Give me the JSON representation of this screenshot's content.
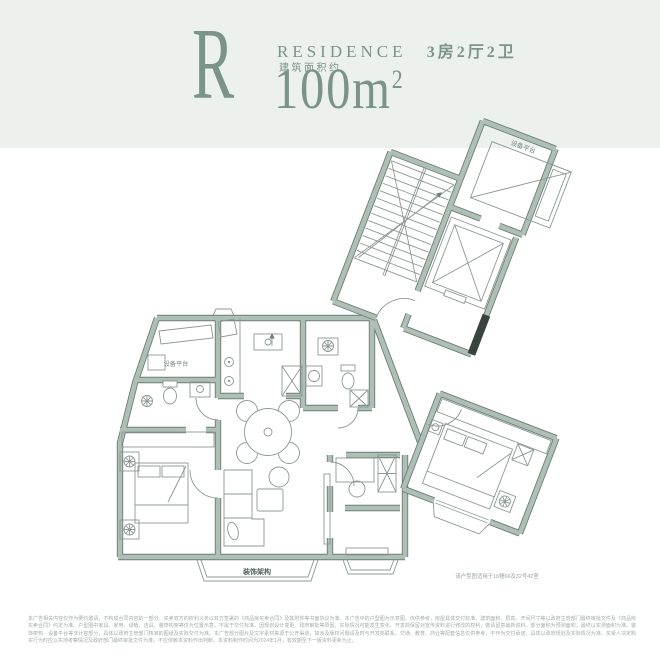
{
  "header": {
    "type_letter": "R",
    "residence_word": "RESIDENCE",
    "rooms_label": "3房2厅2卫",
    "area_prefix": "建筑面积约",
    "area_number": "100",
    "area_unit": "m",
    "area_exponent": "2"
  },
  "plan": {
    "labels": {
      "platform_top": "设备平台",
      "platform_left": "设备平台",
      "decor_structure": "装饰架构",
      "caption": "该户型图适用于16幢66及32号42室"
    }
  },
  "footer": {
    "disclaimer": "本广告相关内容仅作为要约邀请，不构成合同内容的一部分，买卖双方的权利义务以双方签署的《商品房买卖合同》及其附件等书面协议为准。本广告中的户型图为示意图，仅供参考，房屋具体交付标准、建筑面积、层高、开间尺寸等以政府主管部门最终审批文件及《商品房买卖合同》约定为准。户型图中家具、家电、绿植、洁具、装饰构架等仅为位置示意，不属于交付标准。因规划设计变更、政府审批等原因，实际情况可能发生变化，开发商保留对宣传资料进行修改的权利，敬请留意最新资料。部分面积为预测面积，最终以实测面积为准。装饰架构、设备平台等非计容部分，具体以政府主管部门核准的图纸及实际交付为准。本广告部分图片及文字素材来源于公开渠道，如涉及版权问题请及时与开发商联系。交通、教育、商业等配套信息仅供参考，不作为交付承诺，具体以政府规划及实际情况为准。买受人决定购买行为时应以实地考察情况及政府部门最终审批文件为准，不应依赖本资料作出判断。本资料制作时间为2024年1月，有效期至下一版资料更新为止。"
  },
  "colors": {
    "header_bg": "#edf1ee",
    "accent": "#7b948b",
    "wall_fill": "#aebfb5",
    "wall_edge": "#6d7d76",
    "detail_line": "#8d9893",
    "muted_text": "#a2aca7"
  }
}
